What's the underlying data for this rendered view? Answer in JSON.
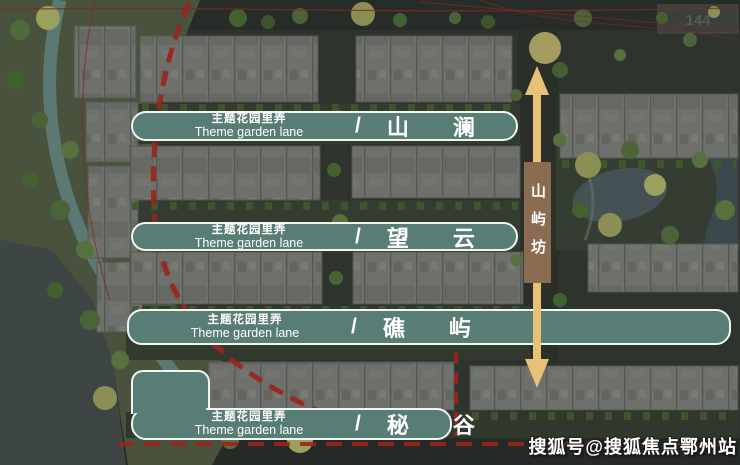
{
  "banners": [
    {
      "lane_cn": "主题花园里弄",
      "lane_en": "Theme garden lane",
      "divider": "/",
      "name": "山澜"
    },
    {
      "lane_cn": "主题花园里弄",
      "lane_en": "Theme garden lane",
      "divider": "/",
      "name": "望云"
    },
    {
      "lane_cn": "主题花园里弄",
      "lane_en": "Theme garden lane",
      "divider": "/",
      "name": "礁屿"
    },
    {
      "lane_cn": "主题花园里弄",
      "lane_en": "Theme garden lane",
      "divider": "/",
      "name": "秘谷"
    }
  ],
  "vertical_lane": {
    "label": "山屿坊"
  },
  "plot_label": {
    "text": "144"
  },
  "watermark": {
    "text": "搜狐号@搜狐焦点鄂州站"
  },
  "colors": {
    "banner_teal": "#587d74",
    "banner_border": "#f2f4f0",
    "arrow_gold": "#e7c178",
    "badge_brown": "#8a6c50",
    "boundary_red": "#9c241b"
  }
}
